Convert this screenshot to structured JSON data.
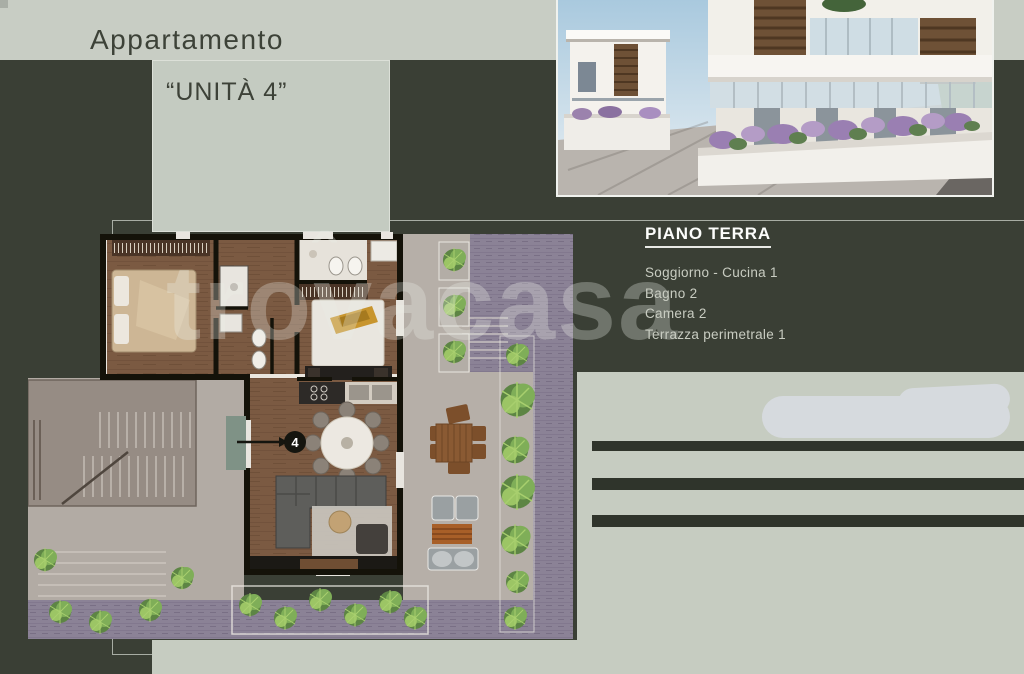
{
  "page": {
    "title": "Appartamento",
    "unit_label": "“UNITÀ 4”",
    "watermark": "trovacasa",
    "background_color": "#3a3f35",
    "band_color": "#c8cdc4",
    "bar_color": "#2f342b"
  },
  "photo": {
    "description": "3D exterior render of modern white apartment buildings with wood-slat screens, glass balconies, lavender planters and paved driveway"
  },
  "floor_info": {
    "heading": "PIANO TERRA",
    "rooms": [
      "Soggiorno - Cucina 1",
      "Bagno 2",
      "Camera 2",
      "Terrazza perimetrale 1"
    ]
  },
  "floor_plan": {
    "unit_number": "4",
    "description": "Top-down ground-floor plan: wood-floor bedrooms and living-kitchen, bathrooms, wrap-around terrace with external stairs, patio with outdoor dining and lounge, plant beds and paved driveway"
  }
}
